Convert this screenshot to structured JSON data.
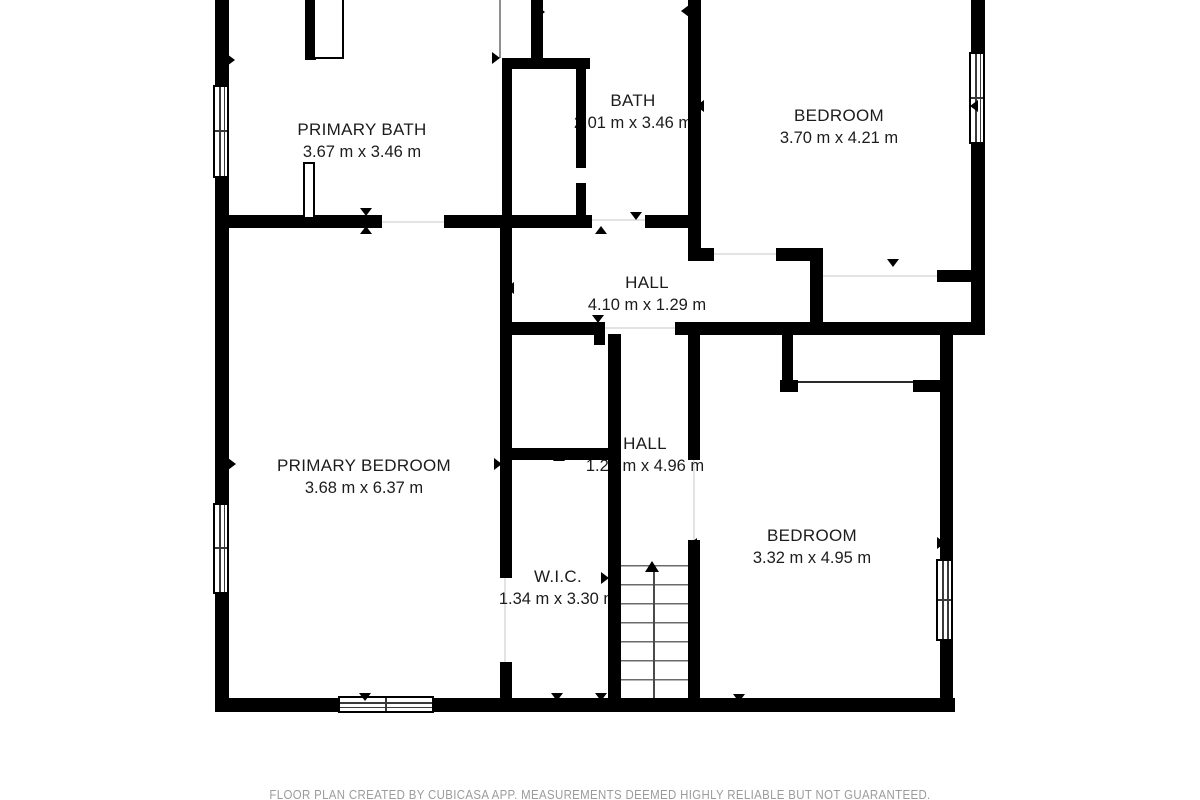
{
  "footer": "FLOOR PLAN CREATED BY CUBICASA APP. MEASUREMENTS DEEMED HIGHLY RELIABLE BUT NOT GUARANTEED.",
  "rooms": [
    {
      "name": "PRIMARY BATH",
      "dimensions": "3.67 m x 3.46 m"
    },
    {
      "name": "BATH",
      "dimensions": "2.01 m x 3.46 m"
    },
    {
      "name": "BEDROOM",
      "dimensions": "3.70 m x 4.21 m"
    },
    {
      "name": "HALL",
      "dimensions": "4.10 m x 1.29 m"
    },
    {
      "name": "PRIMARY BEDROOM",
      "dimensions": "3.68 m x 6.37 m"
    },
    {
      "name": "HALL",
      "dimensions": "1.23 m x 4.96 m"
    },
    {
      "name": "W.I.C.",
      "dimensions": "1.34 m x 3.30 m"
    },
    {
      "name": "BEDROOM",
      "dimensions": "3.32 m x 4.95 m"
    }
  ],
  "stairs": {
    "direction": "up"
  },
  "colors": {
    "wall": "#000000",
    "room_text": "#1c1c1c",
    "footer_text": "#9b9b9b",
    "background": "#ffffff"
  }
}
